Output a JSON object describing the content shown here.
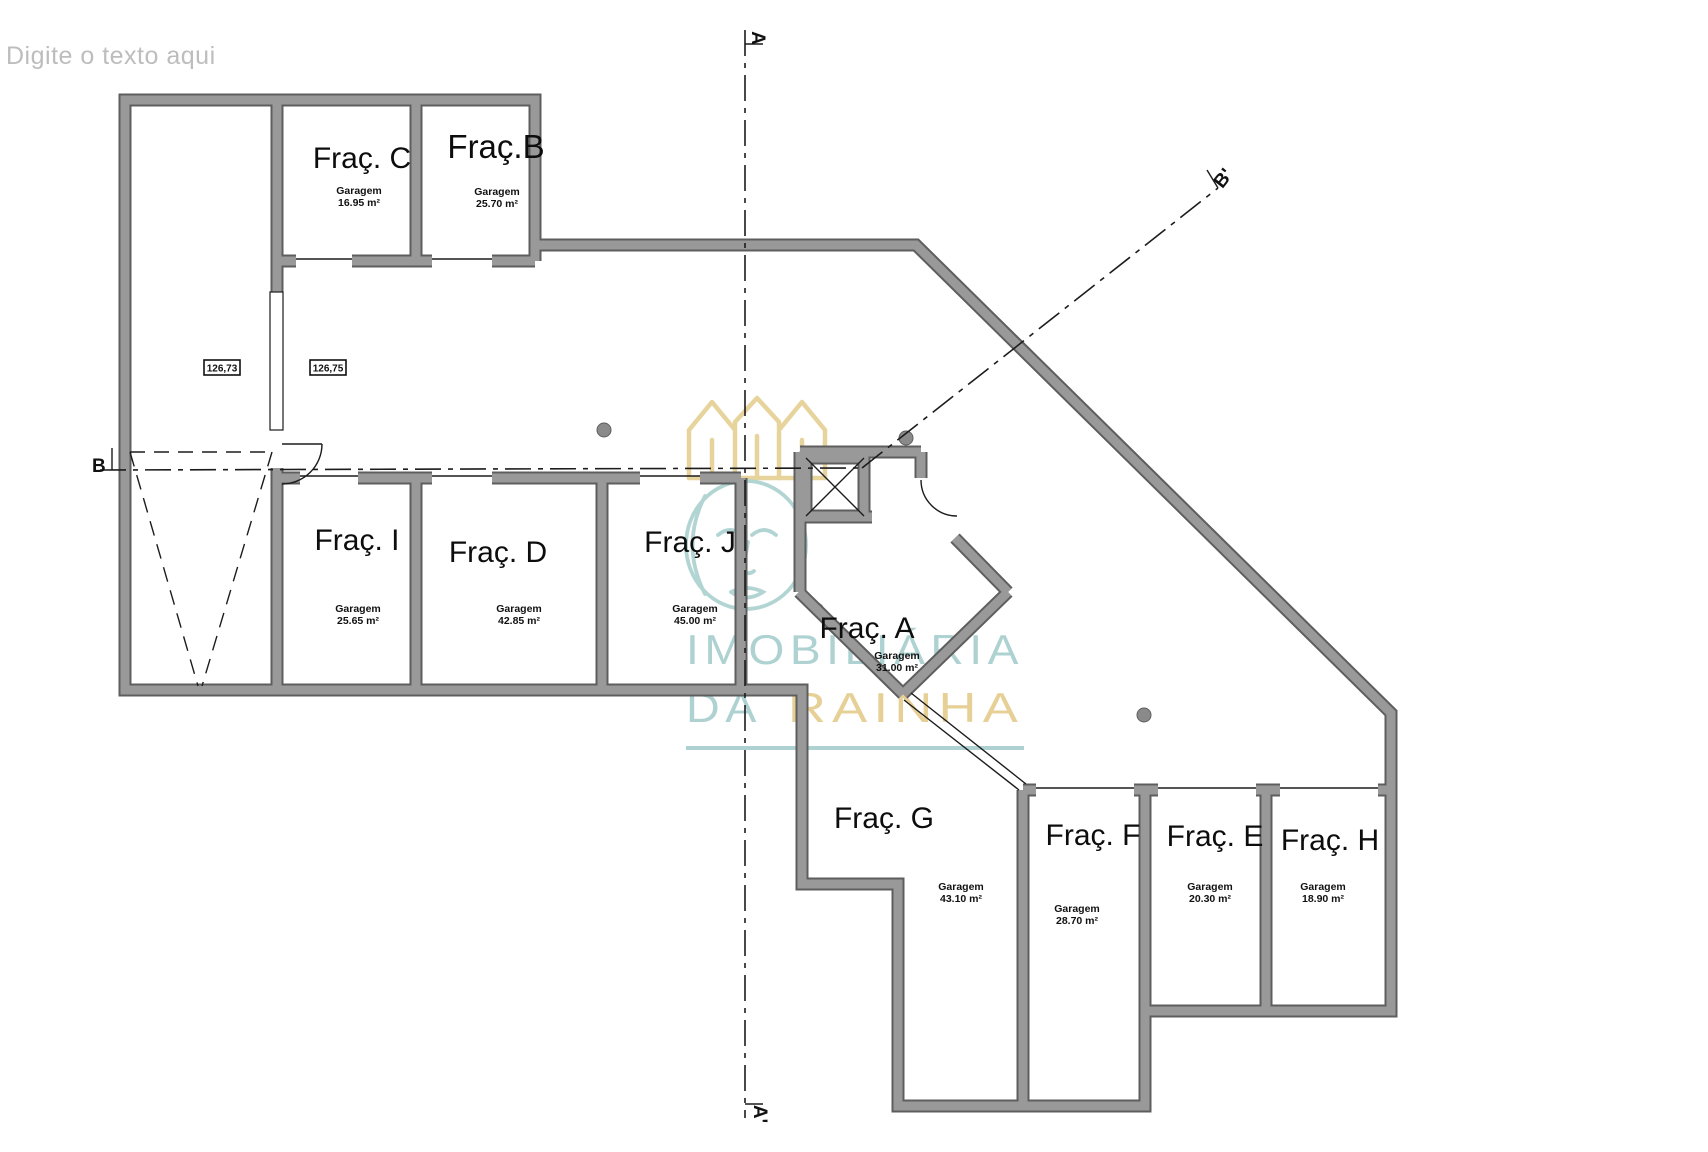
{
  "annotation": {
    "placeholder": "Digite o texto aqui"
  },
  "rooms": [
    {
      "id": "C",
      "label": "Fraç. C",
      "type": "Garagem",
      "area": "16.95 m²"
    },
    {
      "id": "B",
      "label": "Fraç.B",
      "type": "Garagem",
      "area": "25.70 m²"
    },
    {
      "id": "I",
      "label": "Fraç. I",
      "type": "Garagem",
      "area": "25.65 m²"
    },
    {
      "id": "D",
      "label": "Fraç. D",
      "type": "Garagem",
      "area": "42.85 m²"
    },
    {
      "id": "J",
      "label": "Fraç. J",
      "type": "Garagem",
      "area": "45.00 m²"
    },
    {
      "id": "A",
      "label": "Fraç. A",
      "type": "Garagem",
      "area": "31.00 m²"
    },
    {
      "id": "G",
      "label": "Fraç. G",
      "type": "Garagem",
      "area": "43.10 m²"
    },
    {
      "id": "F",
      "label": "Fraç. F",
      "type": "Garagem",
      "area": "28.70 m²"
    },
    {
      "id": "E",
      "label": "Fraç. E",
      "type": "Garagem",
      "area": "20.30 m²"
    },
    {
      "id": "H",
      "label": "Fraç. H",
      "type": "Garagem",
      "area": "18.90 m²"
    }
  ],
  "elevations": [
    {
      "value": "126,73"
    },
    {
      "value": "126,75"
    }
  ],
  "section_lines": {
    "vertical_top": "A",
    "vertical_bottom": "A'",
    "horizontal_left": "B",
    "diagonal_end": "B'"
  },
  "watermark": {
    "registered": "®",
    "brand_line1": "IMOBILIÁRIA",
    "brand_line2_a": "DA",
    "brand_line2_b": "RAINHA",
    "teal": "#aed2d1",
    "gold": "#e6d095"
  },
  "colors": {
    "wall_fill": "#999999",
    "wall_edge": "#5e5e5e",
    "line": "#1c1c1c",
    "placeholder_text": "#bdbdbd"
  }
}
